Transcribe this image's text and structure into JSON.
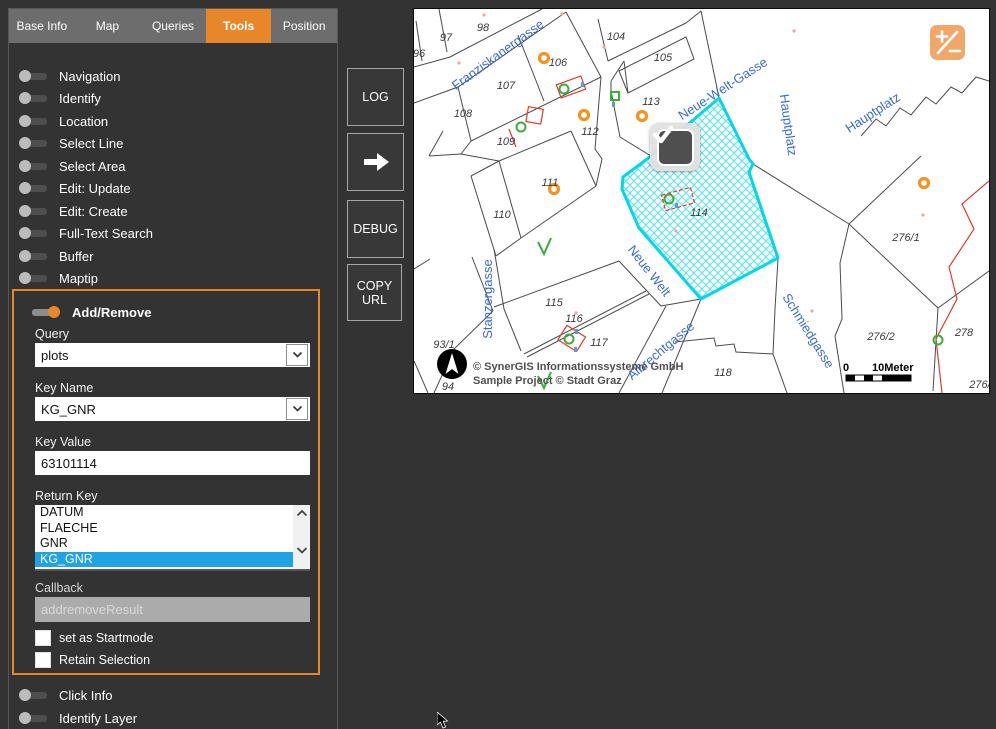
{
  "tabs": [
    "Base Info",
    "Map",
    "Queries",
    "Tools",
    "Position"
  ],
  "active_tab": "Tools",
  "tools_top": [
    "Navigation",
    "Identify",
    "Location",
    "Select Line",
    "Select Area",
    "Edit: Update",
    "Edit: Create",
    "Full-Text Search",
    "Buffer",
    "Maptip"
  ],
  "tools_bottom": [
    "Click Info",
    "Identify Layer"
  ],
  "addremove": {
    "title": "Add/Remove",
    "query_label": "Query",
    "query_value": "plots",
    "keyname_label": "Key Name",
    "keyname_value": "KG_GNR",
    "keyvalue_label": "Key Value",
    "keyvalue_value": "63101114",
    "returnkey_label": "Return Key",
    "returnkey_options": [
      "DATUM",
      "FLAECHE",
      "GNR",
      "KG_GNR"
    ],
    "returnkey_selected": "KG_GNR",
    "callback_label": "Callback",
    "callback_value": "addremoveResult",
    "checkbox1": "set as Startmode",
    "checkbox2": "Retain Selection"
  },
  "actions": {
    "log": "LOG",
    "debug": "DEBUG",
    "copy_url": "COPY URL"
  },
  "map": {
    "streets": [
      "Franziskanergasse",
      "Neue-Welt-Gasse",
      "Hauptplatz",
      "Hauptplatz",
      "Neue Welt",
      "Stanzergasse",
      "Schmiedgasse",
      "Albrechtgasse"
    ],
    "parcels": [
      "96",
      "97",
      "98",
      "104",
      "105",
      "106",
      "107",
      "108",
      "109",
      "110",
      "111",
      "112",
      "113",
      "114",
      "115",
      "116",
      "117",
      "118",
      "276/1",
      "276/2",
      "278",
      "276/",
      "93/1",
      "94"
    ],
    "selected_parcel": "114",
    "copyright_line1": "© SynerGIS Informationssysteme GmbH",
    "copyright_line2": "Sample Project © Stadt Graz",
    "scale_zero": "0",
    "scale_label": "10Meter"
  },
  "colors": {
    "accent_orange": "#e7872a",
    "selection_blue": "#1fa3e2",
    "map_street_blue": "#3a6bd0",
    "selection_cyan": "#00dce8",
    "marker_orange": "#f6921e",
    "marker_green": "#3faa3f",
    "marker_red": "#e23a2e"
  }
}
